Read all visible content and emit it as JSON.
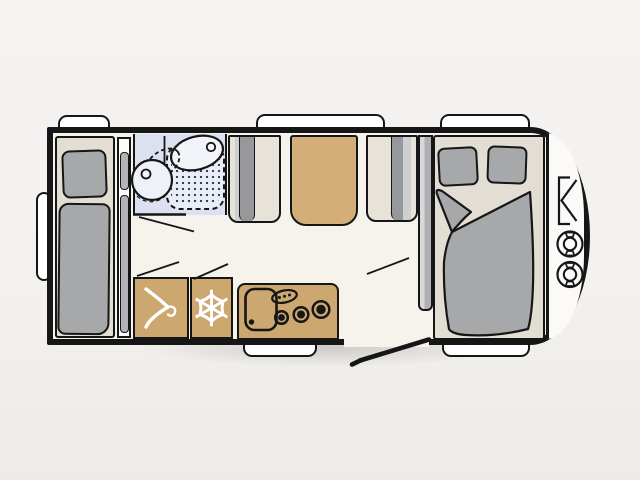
{
  "diagram": {
    "title": "Caravan floor plan",
    "type": "top-down vehicle floor plan",
    "orientation": {
      "front": "right (rounded end with gas locker)",
      "rear": "left (bumper)",
      "entry_door": "bottom, between kitchen and front bed"
    },
    "exterior": {
      "windows_top": 3,
      "windows_bottom": 2,
      "rear_bumper": "white rounded bar on left wall",
      "entry_door": "open door swing line drawn outside bottom wall"
    },
    "rooms": [
      {
        "name": "rear-single-bed",
        "furniture": [
          "bed platform",
          "pillow",
          "mattress",
          "slim side cabinet with 2 shelves"
        ]
      },
      {
        "name": "washroom",
        "furniture": [
          "washbasin on counter",
          "swivel toilet with dashed rotation outline",
          "shower tray with dotted floor"
        ],
        "door": "swing line into corridor"
      },
      {
        "name": "dinette",
        "furniture": [
          "bench seat left with gray backrest",
          "table",
          "bench seat right with gray backrest"
        ]
      },
      {
        "name": "kitchen",
        "furniture": [
          "wardrobe",
          "refrigerator",
          "kitchen unit with sink and 3-burner hob",
          "control panel with 3 knobs"
        ]
      },
      {
        "name": "front-double-bed",
        "furniture": [
          "tall cabinet",
          "double bed platform",
          "two pillows",
          "duvet with folded corner"
        ]
      },
      {
        "name": "gas-locker",
        "furniture": [
          "drawbar bracket symbol",
          "gas bottle",
          "gas bottle"
        ]
      }
    ],
    "icons": [
      "hanger-icon",
      "snowflake-icon",
      "gas-bottle-icon",
      "burner-icon",
      "basin-icon",
      "toilet-icon"
    ],
    "colors": {
      "wall": "#161616",
      "floor": "#f6f3ed",
      "furniture_beige": "#e3ded3",
      "cushion_gray": "#a6a8aa",
      "backrest_dark_gray": "#96989b",
      "wood_tan": "#cda770",
      "table_tan": "#d3ae78",
      "washroom_blue": "#dbe1f0",
      "white": "#ffffff",
      "background": "#f3f1ee"
    }
  }
}
